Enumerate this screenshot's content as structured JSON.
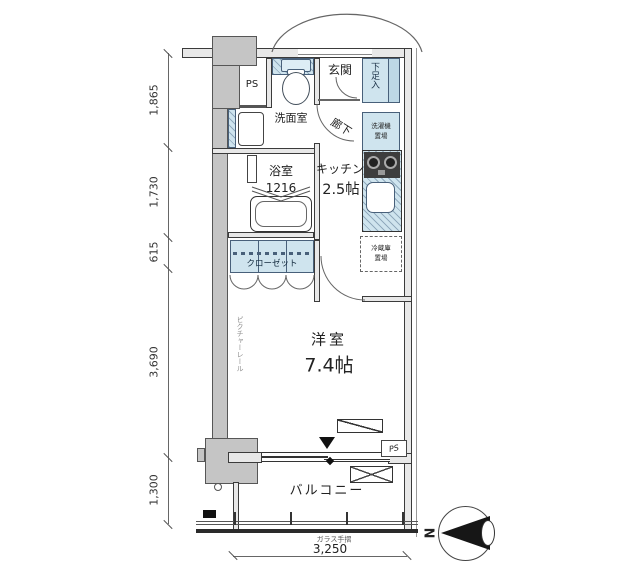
{
  "colors": {
    "fixture_blue": "#cfe4ee",
    "pillar_gray": "#c5c5c5",
    "wall_line": "#3b3b3b"
  },
  "dimensions": {
    "left": [
      {
        "label": "1,865"
      },
      {
        "label": "1,730"
      },
      {
        "label": "615"
      },
      {
        "label": "3,690"
      },
      {
        "label": "1,300"
      }
    ],
    "bottom": {
      "label": "3,250"
    }
  },
  "rooms": {
    "genkan": "玄関",
    "shoe_box": "下足入",
    "pipe_space_top": "PS",
    "washroom": "洗面室",
    "corridor": "廊下",
    "washer": {
      "line1": "洗濯機",
      "line2": "置場"
    },
    "bathroom": "浴室",
    "bathroom_size": "1216",
    "kitchen": "キッチン",
    "kitchen_size": "2.5帖",
    "fridge": {
      "line1": "冷蔵庫",
      "line2": "置場"
    },
    "closet": "クローゼット",
    "western_room": "洋室",
    "western_room_size": "7.4帖",
    "picture_rail": "ピクチャーレール",
    "balcony": "バルコニー",
    "glass_rail": "ガラス手摺",
    "pipe_space_bottom": "PS"
  },
  "compass": {
    "north": "N"
  }
}
